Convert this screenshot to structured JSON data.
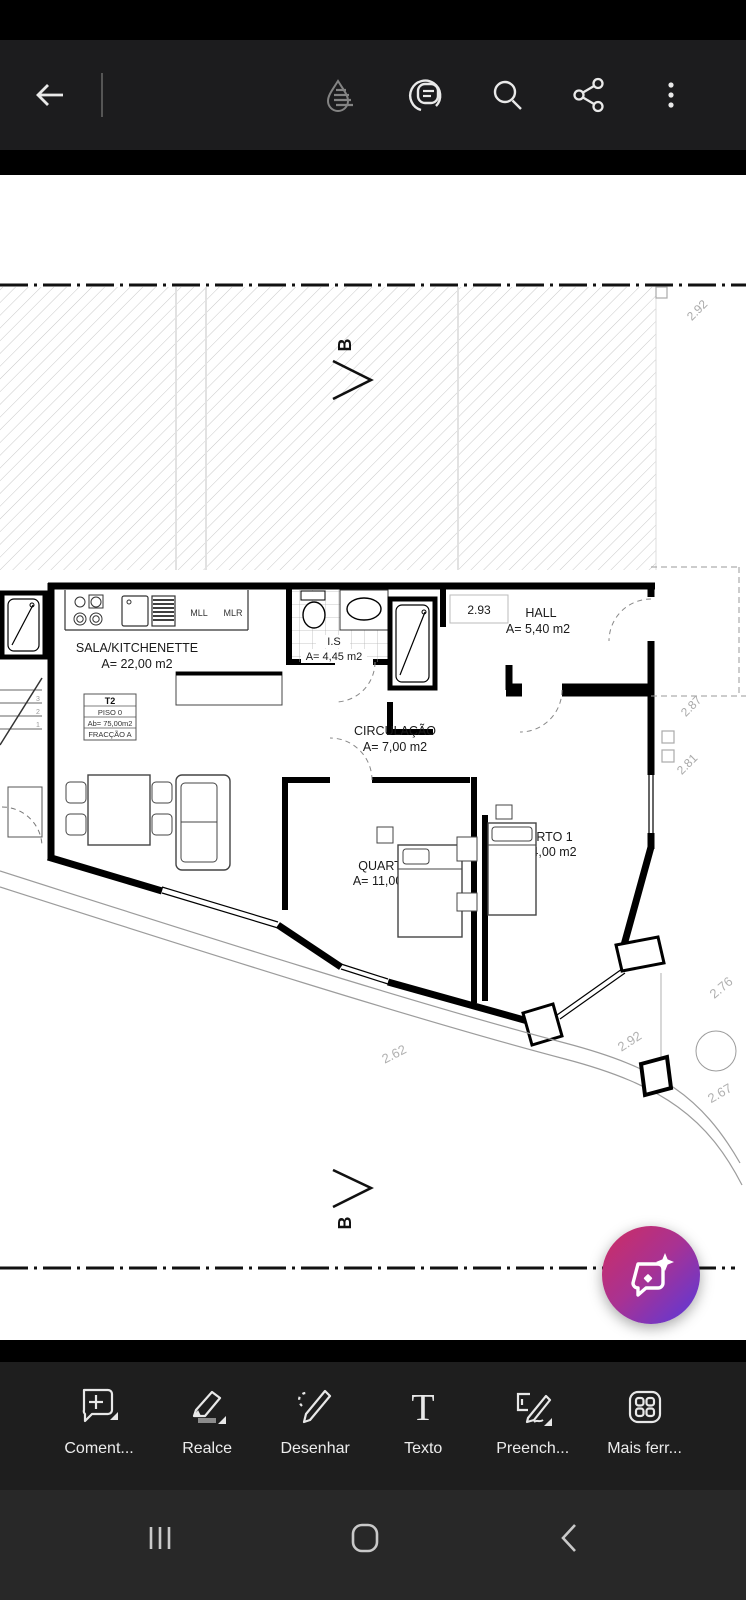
{
  "app_bar": {
    "icons": [
      "back",
      "liquid-mode",
      "comments-view",
      "search",
      "share",
      "overflow-menu"
    ]
  },
  "plan": {
    "section_marker": "B",
    "kitchen_labels": {
      "mll": "MLL",
      "mlr": "MLR"
    },
    "rooms": {
      "sala": {
        "name": "SALA/KITCHENETTE",
        "area": "A= 22,00 m2"
      },
      "is": {
        "name": "I.S",
        "area": "A= 4,45 m2"
      },
      "hall": {
        "name": "HALL",
        "area": "A= 5,40 m2"
      },
      "circulacao": {
        "name": "CIRCULAÇÃO",
        "area": "A= 7,00 m2"
      },
      "quarto2": {
        "name": "QUARTO 2",
        "area": "A= 11,00 m2"
      },
      "quarto1": {
        "name": "QUARTO 1",
        "area": "A= 14,00 m2"
      }
    },
    "unit_table": {
      "type": "T2",
      "floor": "PISO 0",
      "gross_area": "Ab= 75,00m2",
      "fraction": "FRACÇÃO A"
    },
    "stair_numbers": [
      "3",
      "2",
      "1"
    ],
    "dimensions": {
      "top_right": "2.92",
      "hall_width": "2.93",
      "right_upper": "2.87",
      "right_lower": "2.81",
      "bottom_left": "2.62",
      "bottom_middle": "2.92",
      "corner_upper": "2.76",
      "corner_lower": "2.67"
    },
    "clipped_text": "ANTA"
  },
  "fab": {
    "accent_start": "#ce2d62",
    "accent_end": "#5739dd"
  },
  "toolbar": {
    "tools": [
      {
        "id": "comment",
        "label": "Coment..."
      },
      {
        "id": "highlight",
        "label": "Realce"
      },
      {
        "id": "draw",
        "label": "Desenhar"
      },
      {
        "id": "text",
        "label": "Texto"
      },
      {
        "id": "fill_sign",
        "label": "Preench..."
      },
      {
        "id": "more_tools",
        "label": "Mais ferr..."
      }
    ]
  },
  "nav_bar": {
    "icons": [
      "recents",
      "home",
      "back"
    ]
  }
}
